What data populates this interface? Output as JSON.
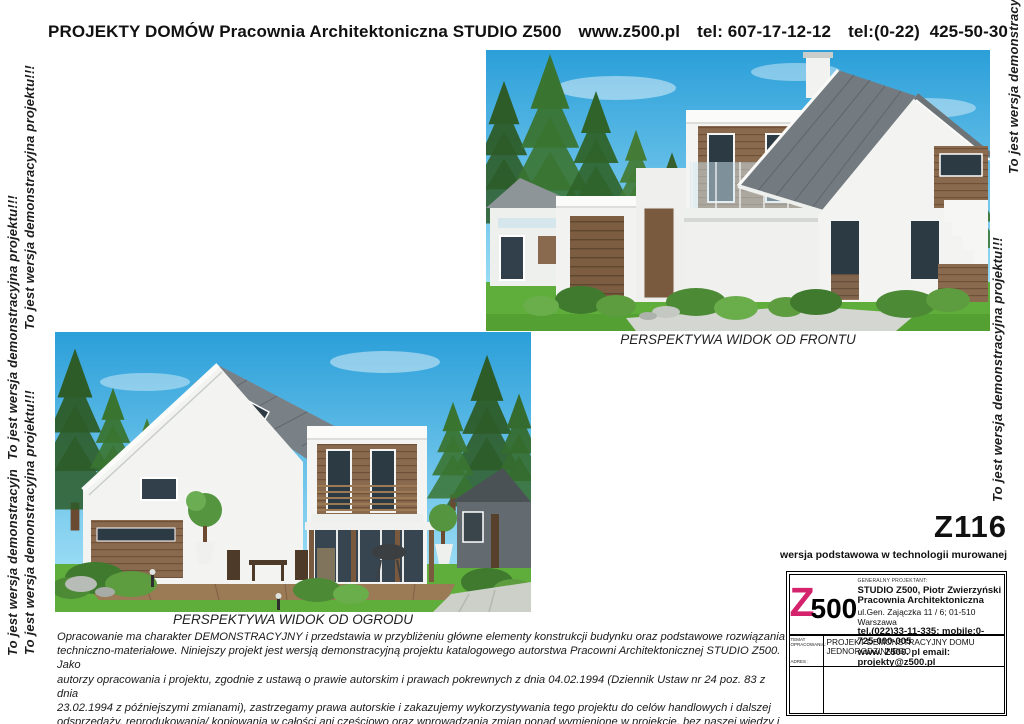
{
  "header": {
    "segments": [
      "PROJEKTY DOMÓW Pracownia Architektoniczna STUDIO Z500",
      "www.z500.pl",
      "tel: 607-17-12-12",
      "tel:(0-22)  425-50-30"
    ]
  },
  "watermark": {
    "text": "To jest wersja demonstracyjna projektu!!!"
  },
  "images": {
    "front": {
      "caption": "PERSPEKTYWA WIDOK OD FRONTU"
    },
    "garden": {
      "caption": "PERSPEKTYWA WIDOK OD OGRODU"
    }
  },
  "project": {
    "code": "Z116",
    "variant": "wersja podstawowa w technologii murowanej"
  },
  "titleblock": {
    "designer_label": "GENERALNY PROJEKTANT:",
    "logo_z": "Z",
    "logo_500": "500",
    "company_line1": "STUDIO Z500, Piotr Zwierzyński",
    "company_line2": "Pracownia Architektoniczna",
    "address": "ul.Gen. Zajączka 11 / 6; 01-510 Warszawa",
    "phones": "tel.(022)33-11-335; mobile:0-725-000-005",
    "web_email": "www. Z500. pl   email: projekty@z500.pl",
    "temat_label": "TEMAT OPRACOWANIA:",
    "adres_label": "ADRES :",
    "temat_value": "PROJEKT DEMONSTRACYJNY DOMU JEDNORODZINNEGO"
  },
  "disclaimer": {
    "lines": [
      "Opracowanie ma charakter DEMONSTRACYJNY i przedstawia w przybliżeniu główne elementy konstrukcji budynku oraz podstawowe rozwiązania",
      "techniczno-materiałowe. Niniejszy projekt jest wersją demonstracyjną projektu katalogowego autorstwa Pracowni Architektonicznej STUDIO Z500. Jako",
      "autorzy opracowania i projektu, zgodnie z ustawą o prawie autorskim i prawach pokrewnych z dnia 04.02.1994 (Dziennik Ustaw nr 24 poz. 83 z dnia",
      "23.02.1994 z późniejszymi zmianami), zastrzegamy prawa autorskie i zakazujemy wykorzystywania tego projektu do celów handlowych i dalszej",
      "odsprzedaży, reprodukowania/ kopiowania w całości ani częściowo oraz wprowadzania zmian ponad wymienione w projekcie, bez naszej wiedzy i zgody"
    ]
  },
  "colors": {
    "logo_magenta": "#d4226d",
    "sky_blue": "#2fa3df",
    "roof_gray": "#757c81",
    "wood_brown": "#8a6a4e",
    "lawn_green": "#5fae3c"
  }
}
